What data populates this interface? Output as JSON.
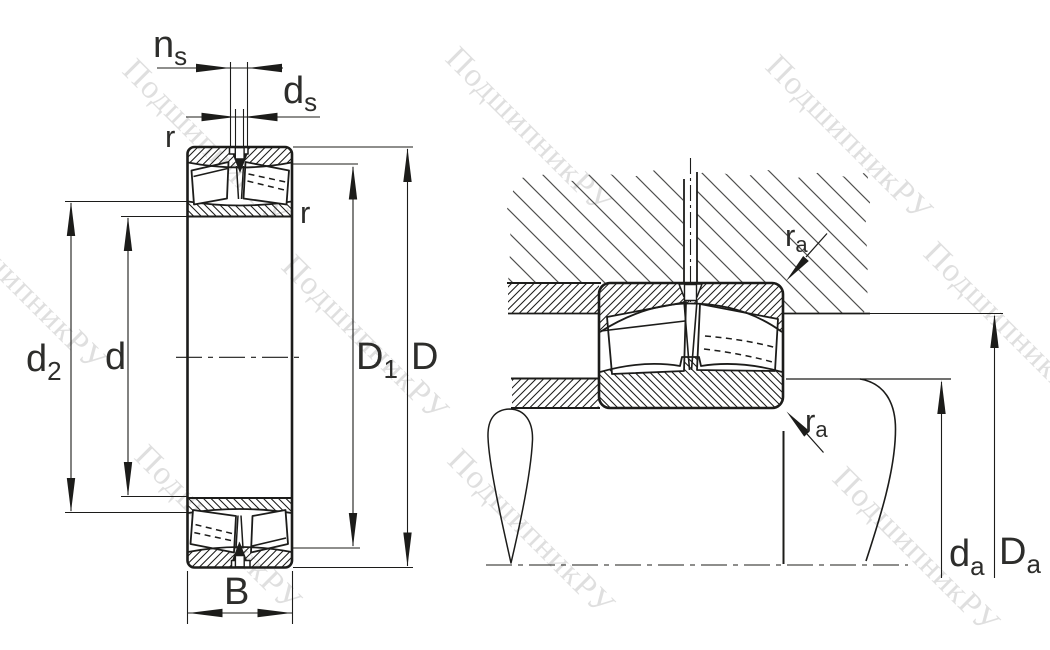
{
  "watermark": {
    "text": "ПодшипникРУ"
  },
  "dims": {
    "ns": {
      "main": "n",
      "sub": "s"
    },
    "ds": {
      "main": "d",
      "sub": "s"
    },
    "r_outer": {
      "main": "r"
    },
    "r_inner": {
      "main": "r"
    },
    "d2": {
      "main": "d",
      "sub": "2"
    },
    "d": {
      "main": "d"
    },
    "D1": {
      "main": "D",
      "sub": "1"
    },
    "D": {
      "main": "D"
    },
    "B": {
      "main": "B"
    },
    "ra_top": {
      "main": "r",
      "sub": "a"
    },
    "ra_bottom": {
      "main": "r",
      "sub": "a"
    },
    "da": {
      "main": "d",
      "sub": "a"
    },
    "Da": {
      "main": "D",
      "sub": "a"
    }
  },
  "colors": {
    "line": "#1c1c1a",
    "label": "#2d2d2b",
    "watermark": "#c6c6c6",
    "housing_hatch": "#4f4f4d",
    "background": "#ffffff"
  }
}
